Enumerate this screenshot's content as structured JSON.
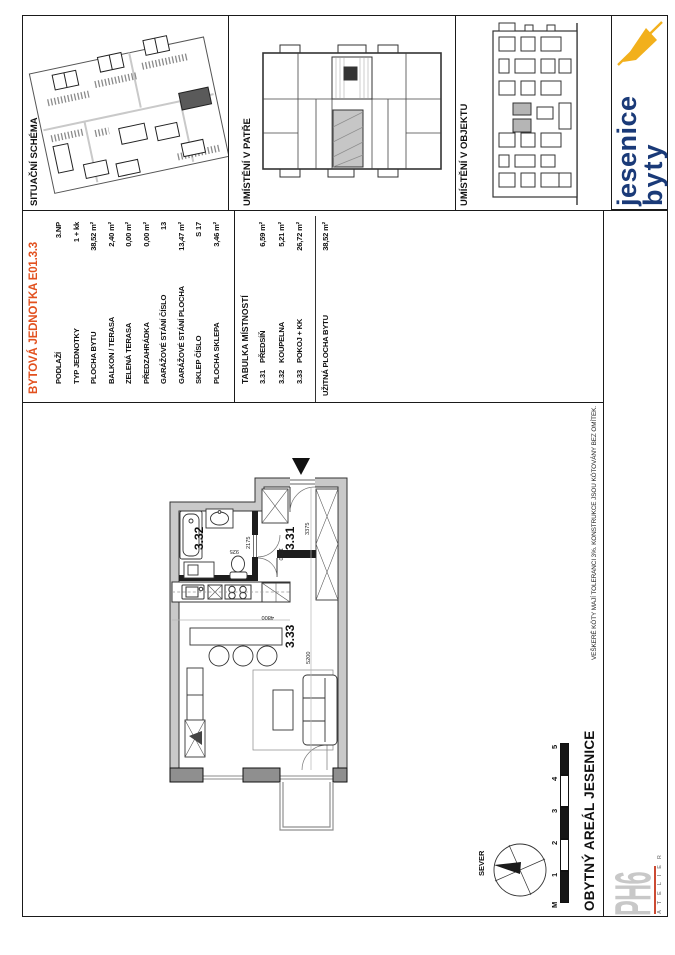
{
  "panels": {
    "site": {
      "label": "SITUAČNÍ SCHÉMA"
    },
    "floor": {
      "label": "UMÍSTĚNÍ V PATŘE"
    },
    "building": {
      "label": "UMÍSTĚNÍ V OBJEKTU"
    }
  },
  "logo": {
    "byty": "byty",
    "jesenice": "jesenice"
  },
  "colors": {
    "accent_orange": "#e2511f",
    "logo_blue": "#1a3a78",
    "logo_yellow": "#f2b01c"
  },
  "unit": {
    "title": "BYTOVÁ JEDNOTKA E01.3.3",
    "rows": [
      {
        "label": "PODLAŽÍ",
        "value": "3.NP"
      },
      {
        "label": "TYP JEDNOTKY",
        "value": "1 + kk"
      },
      {
        "label": "PLOCHA BYTU",
        "value": "38,52 m²"
      },
      {
        "label": "BALKON / TERASA",
        "value": "2,40 m²"
      },
      {
        "label": "ZELENÁ TERASA",
        "value": "0,00 m²"
      },
      {
        "label": "PŘEDZAHRÁDKA",
        "value": "0,00 m²"
      },
      {
        "label": "GARÁŽOVÉ STÁNÍ ČÍSLO",
        "value": "13"
      },
      {
        "label": "GARÁŽOVÉ STÁNÍ PLOCHA",
        "value": "13,47 m²"
      },
      {
        "label": "SKLEP ČÍSLO",
        "value": "S 17"
      },
      {
        "label": "PLOCHA SKLEPA",
        "value": "3,46 m²"
      }
    ]
  },
  "rooms": {
    "title": "TABULKA MÍSTNOSTÍ",
    "items": [
      {
        "num": "3.31",
        "name": "PŘEDSÍŇ",
        "area": "6,59 m²"
      },
      {
        "num": "3.32",
        "name": "KOUPELNA",
        "area": "5,21 m²"
      },
      {
        "num": "3.33",
        "name": "POKOJ + KK",
        "area": "26,72 m²"
      }
    ],
    "total_label": "UŽITNÁ PLOCHA BYTU",
    "total_value": "38,52 m²"
  },
  "plan": {
    "labels": {
      "hall": "3.31",
      "bath": "3.32",
      "living": "3.33"
    },
    "dims": {
      "d3375": "3375",
      "d1750": "1750",
      "d2175": "2175",
      "d925": "925",
      "d4800": "4800",
      "d5200": "5200"
    }
  },
  "footer": {
    "north_label": "SEVER",
    "scale_unit": "M",
    "scale_ticks": [
      "1",
      "2",
      "3",
      "4",
      "5"
    ],
    "project_title": "OBYTNÝ AREÁL JESENICE",
    "note": "VEŠKERÉ KÓTY MAJÍ TOLERANCI 3%. KONSTRUKCE JSOU KÓTOVÁNY BEZ OMÍTEK.",
    "studio": {
      "name": "PH6",
      "sub": "A T E L I E R"
    }
  }
}
